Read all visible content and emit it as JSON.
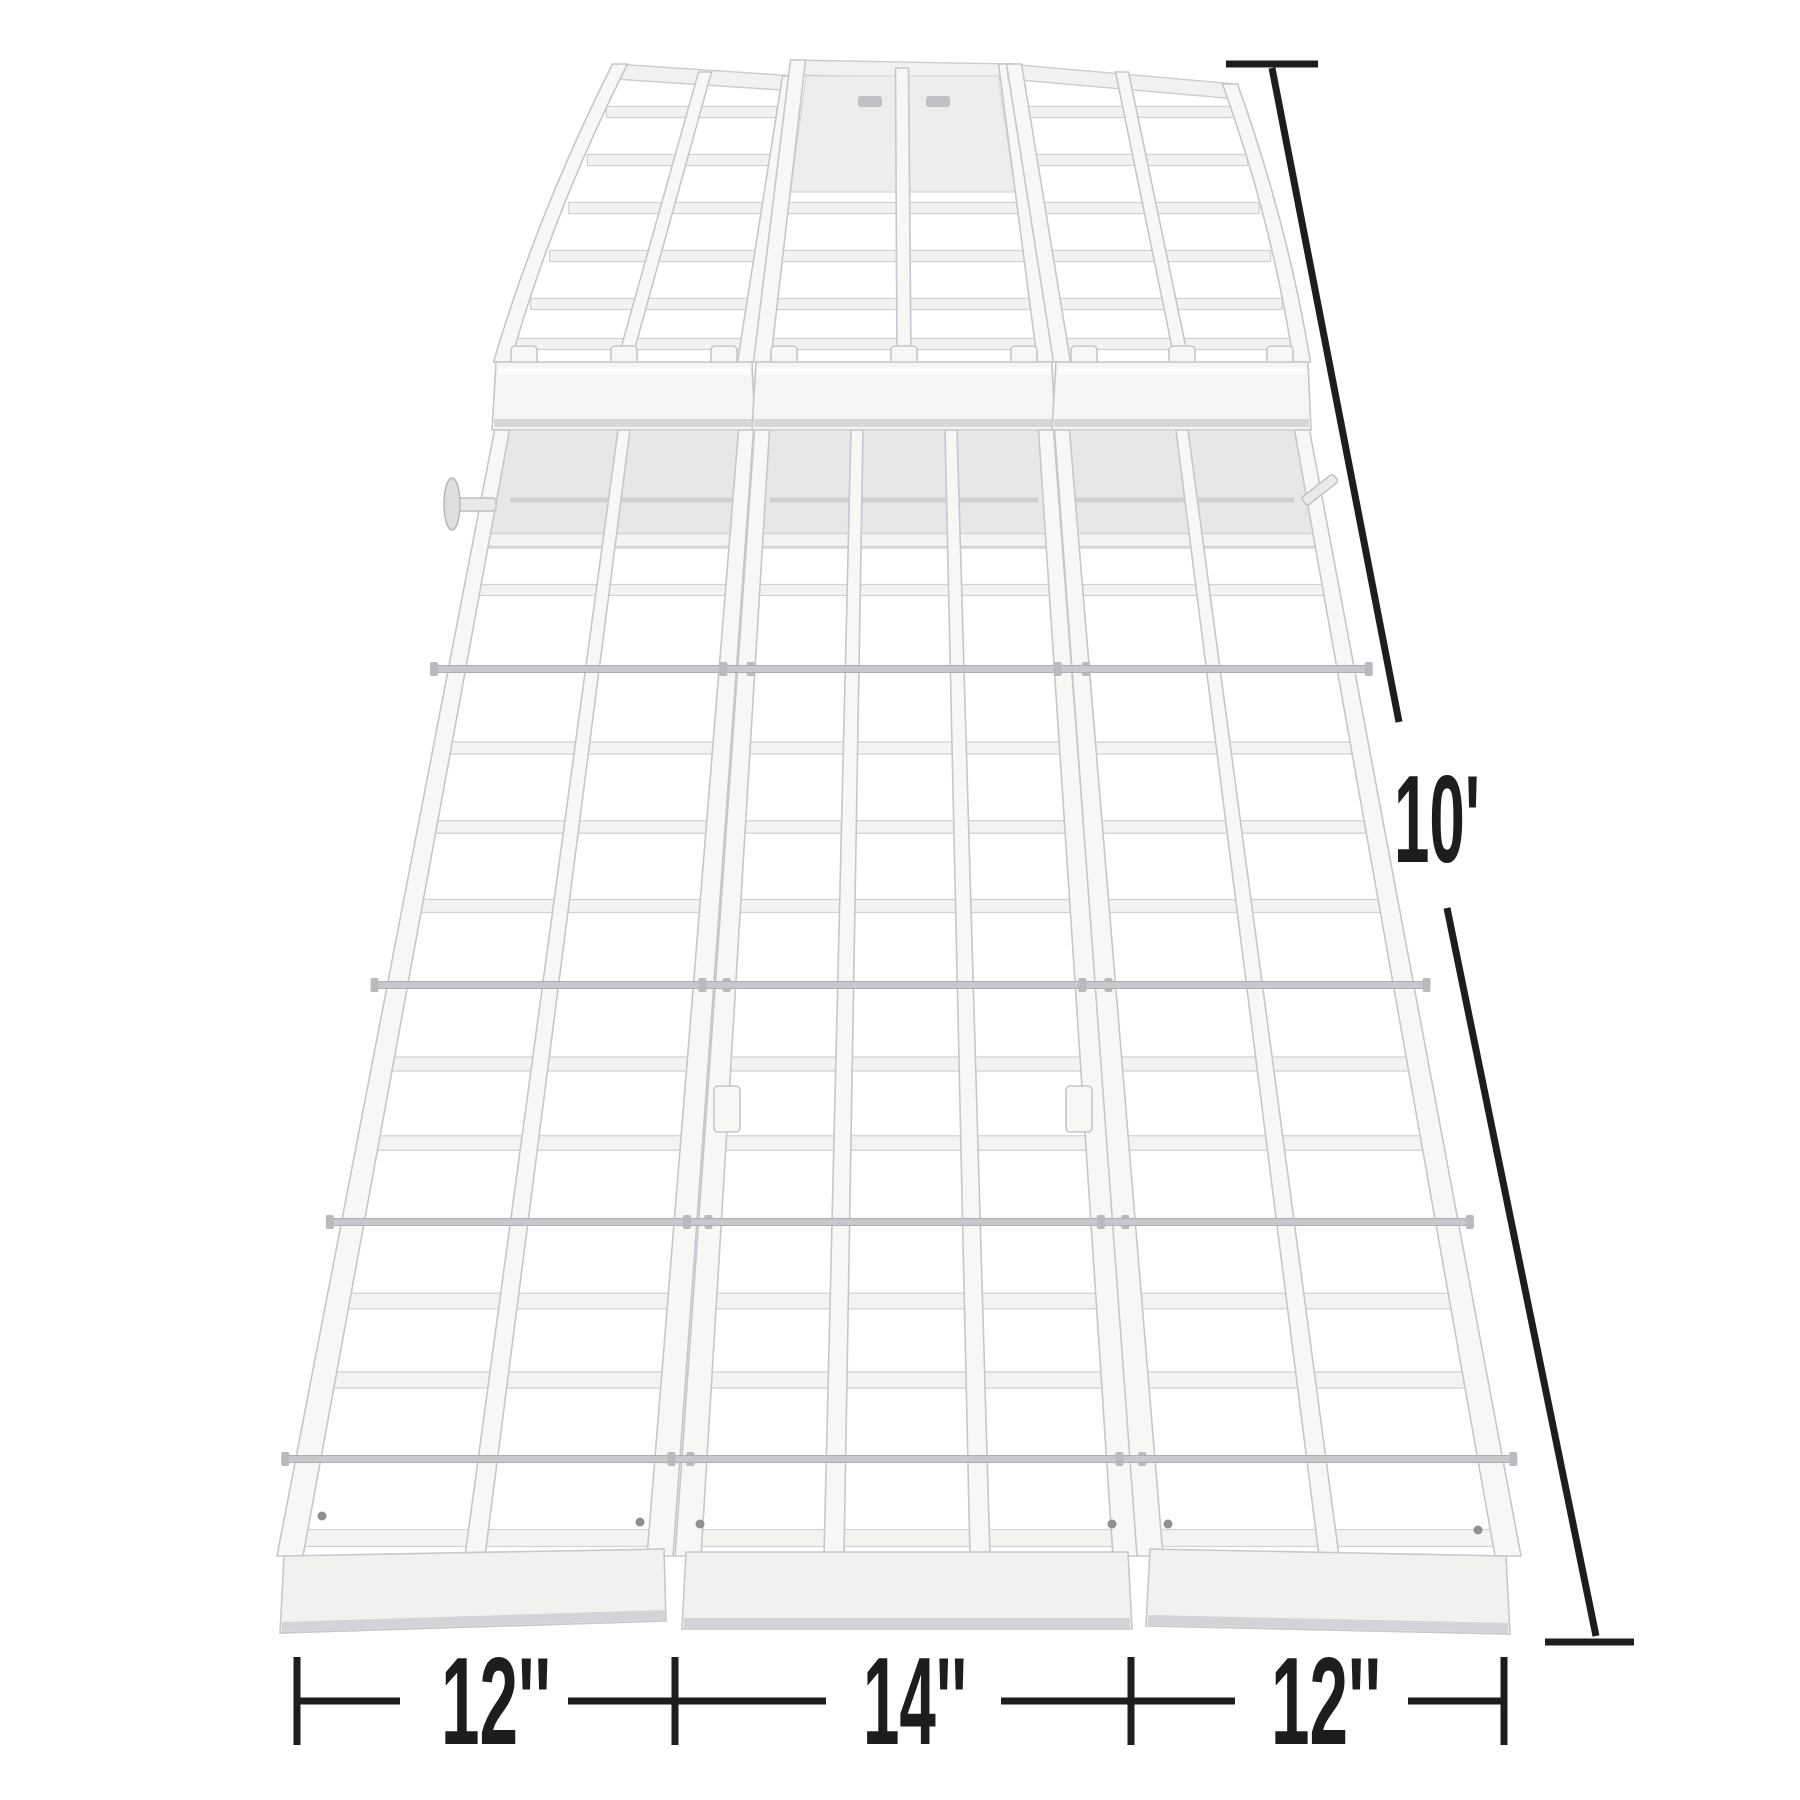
{
  "image": {
    "background": "#ffffff",
    "subject": "white aluminum tri-fold arched loading ramp viewed from the low end",
    "ramp_color": "#f5f5f4"
  },
  "annotations": {
    "text_color": "#1d1d1b",
    "length": {
      "label": "10'"
    },
    "section_widths": [
      {
        "label": "12''"
      },
      {
        "label": "14''"
      },
      {
        "label": "12''"
      }
    ]
  }
}
